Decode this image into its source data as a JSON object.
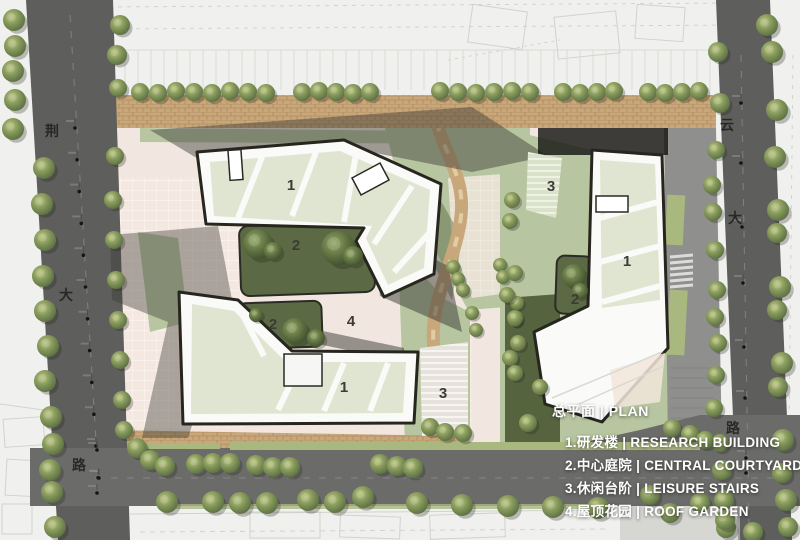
{
  "legend": {
    "title": "总平面 | PLAN",
    "items": [
      "1.研发楼 | RESEARCH BUILDING",
      "2.中心庭院 | CENTRAL COURTYARD",
      "3.休闲台阶 | LEISURE STAIRS",
      "4.屋顶花园 | ROOF GARDEN"
    ]
  },
  "roads": {
    "left": {
      "chars": [
        "荆",
        "大",
        "路"
      ]
    },
    "right": {
      "chars": [
        "云",
        "大",
        "路"
      ]
    }
  },
  "markers": {
    "research_building": "1",
    "central_courtyard": "2",
    "leisure_stairs": "3",
    "roof_garden": "4"
  },
  "colors": {
    "road": "#5e5e5c",
    "road_bottom": "#6b6b69",
    "sidewalk": "#8f8f8d",
    "brick": "#c8a77b",
    "paving": "#f1e7e0",
    "lawn": "#b7c5a0",
    "lawn_dark": "#55633f",
    "verge": "#a9b87f",
    "courtyard": "#5b6a44",
    "roof_panel": "#dfe5d0",
    "building": "#fafaf8",
    "outline": "#26261f",
    "shadow": "#3a3a33",
    "legend_text": "#ffffff"
  }
}
